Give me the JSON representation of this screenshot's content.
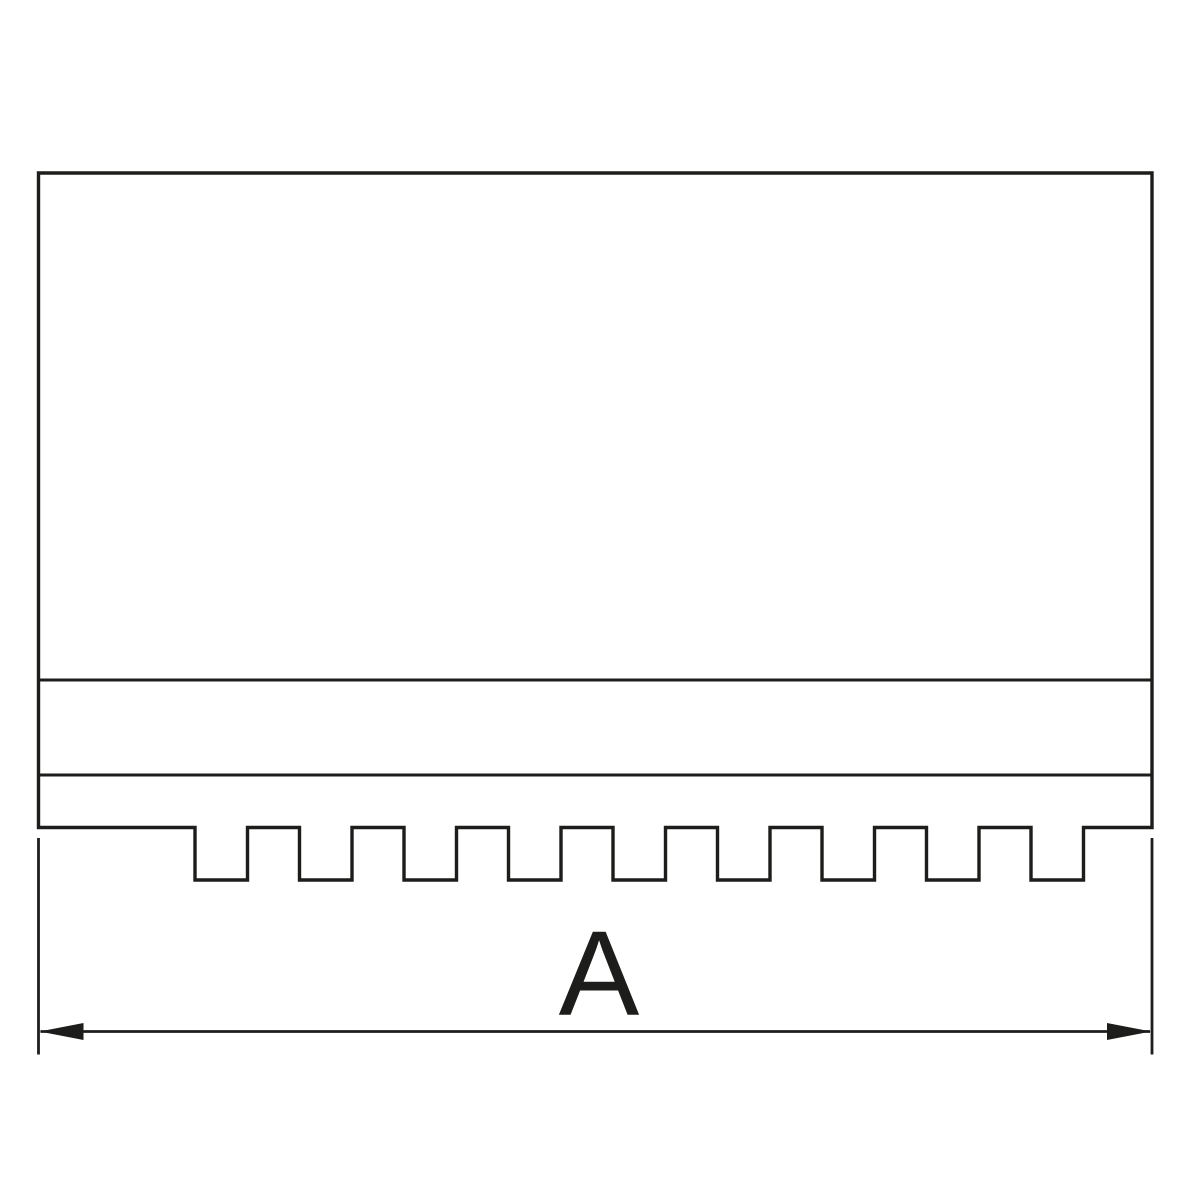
{
  "diagram": {
    "type": "technical-drawing-front-view",
    "line_color": "#1d1d1b",
    "background_color": "#ffffff",
    "canvas": {
      "width": 1200,
      "height": 1200
    },
    "body": {
      "left": 38.5,
      "right": 1152,
      "top": 173,
      "step_line_upper_y": 680,
      "step_line_lower_y": 775,
      "serration_top_y": 827.5,
      "serration_bottom_y": 880
    },
    "serrations": {
      "notch_count": 9,
      "first_notch_x": 195,
      "notch_width": 52.5,
      "pitch": 104.5
    },
    "dimension": {
      "label": "A",
      "line_y": 1031.5,
      "left_x": 38.5,
      "right_x": 1152,
      "extension_top_y": 838,
      "extension_bottom_y": 1054.5,
      "arrow_length": 44,
      "arrow_half_height": 8.5,
      "label_x": 599,
      "label_baseline_y": 1015,
      "label_font_size": 121
    }
  }
}
